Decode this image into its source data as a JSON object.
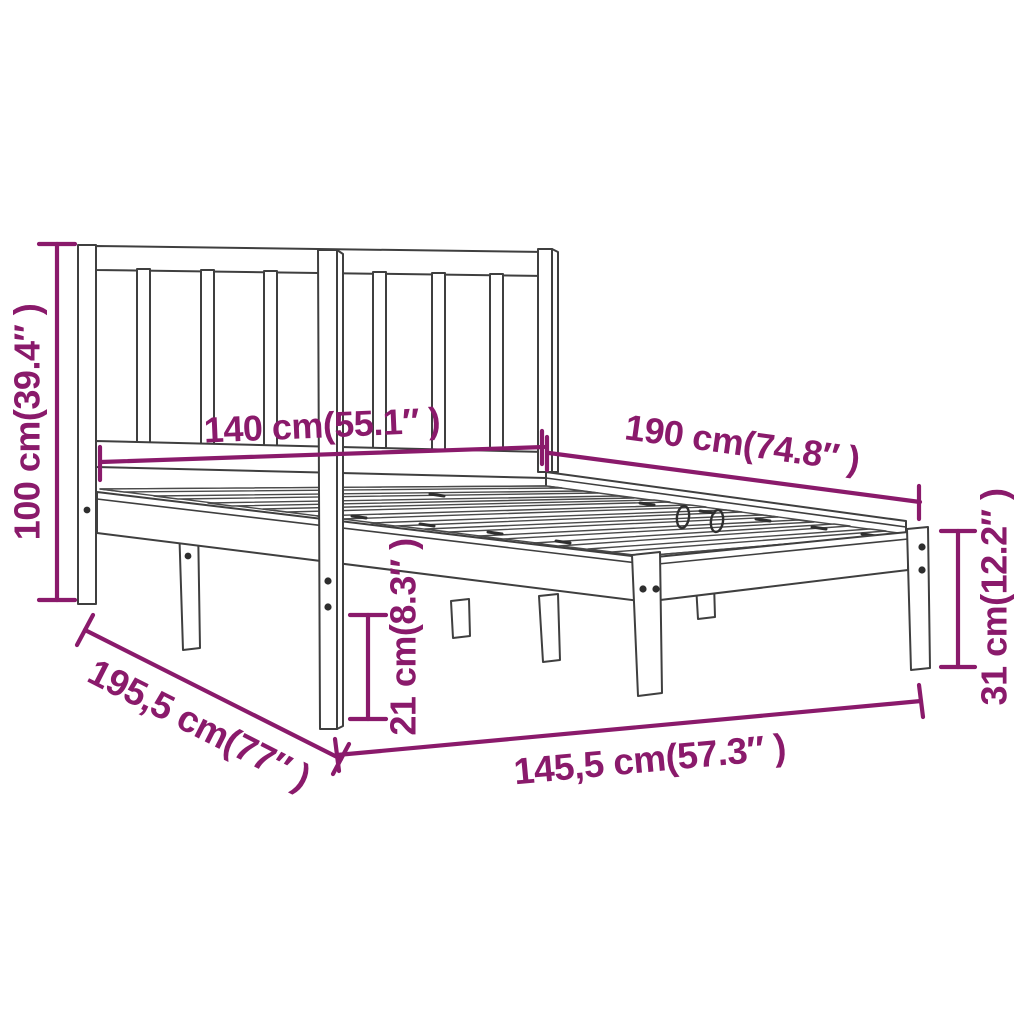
{
  "diagram": {
    "kind": "product-dimension-diagram",
    "subject": "wooden bed frame with slatted headboard, three-quarter line drawing",
    "background_color": "#ffffff",
    "artwork_line_color": "#3f3f3f",
    "dimension_color": "#8a1a6b",
    "dimensions": {
      "headboard_height": "100 cm(39.4″ )",
      "mattress_width": "140 cm(55.1″ )",
      "mattress_length": "190 cm(74.8″ )",
      "side_rail_height": "31 cm(12.2″ )",
      "under_bed_clearance": "21 cm(8.3″ )",
      "total_length": "195,5 cm(77″ )",
      "total_width": "145,5 cm(57.3″ )"
    }
  }
}
